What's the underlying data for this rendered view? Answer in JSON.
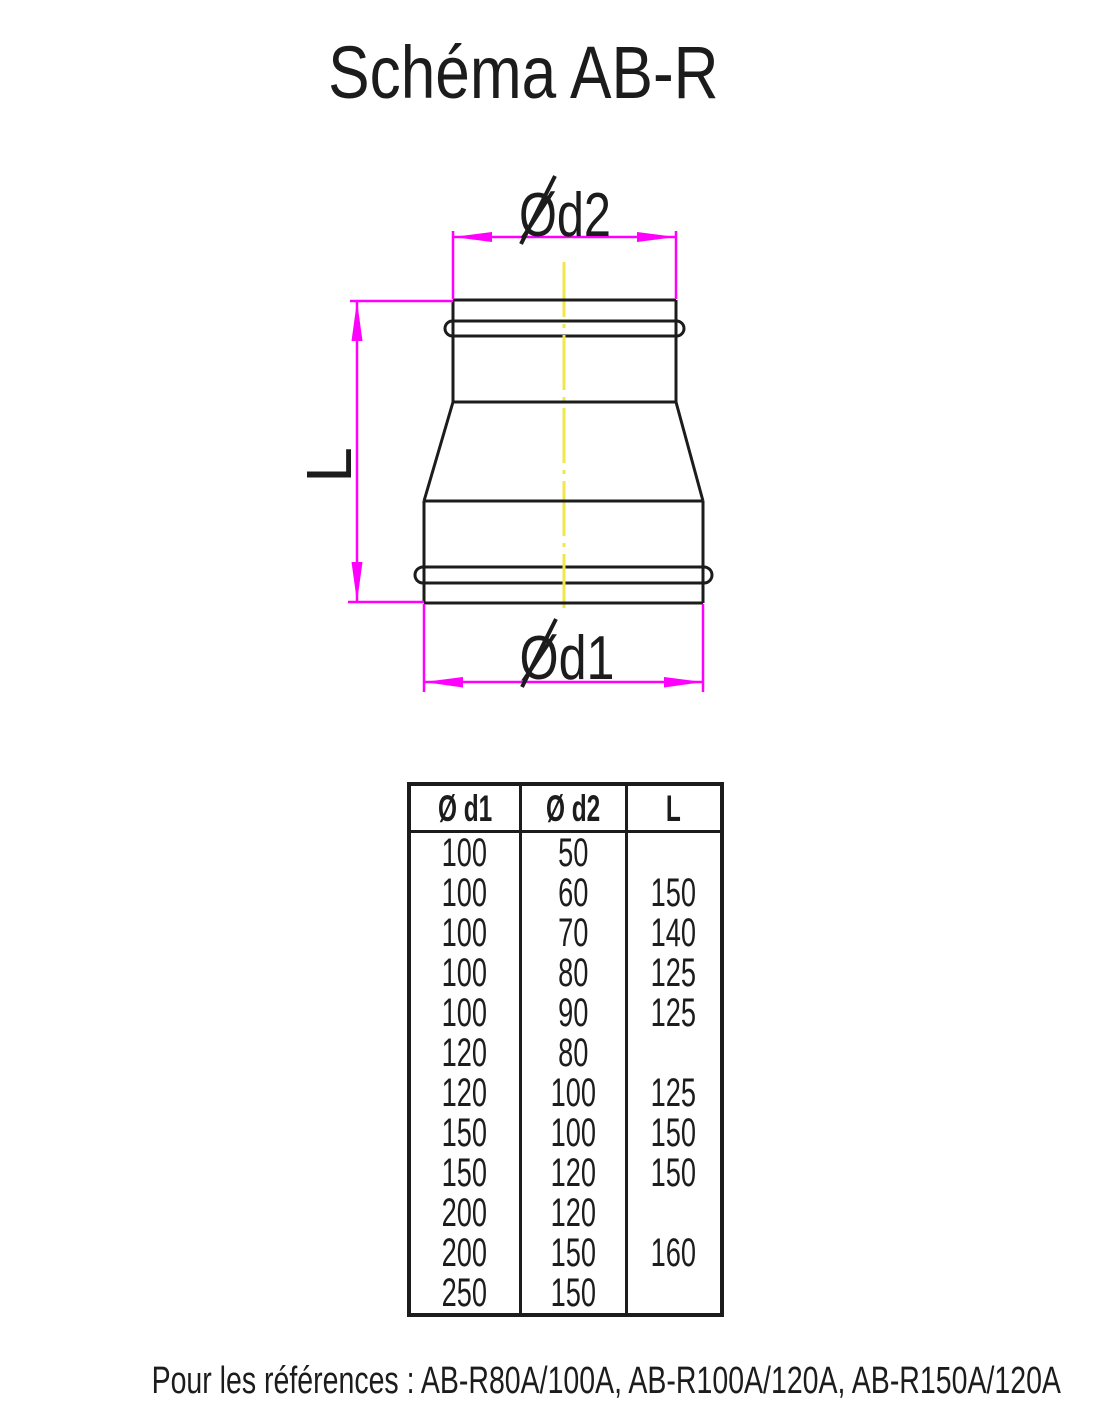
{
  "page": {
    "title": "Schéma AB-R",
    "footer": "Pour les références : AB-R80A/100A, AB-R100A/120A, AB-R150A/120A"
  },
  "diagram": {
    "labels": {
      "d2": "Ød2",
      "d1": "Ød1",
      "length": "L"
    },
    "colors": {
      "dimension": "#FF00FF",
      "centerline": "#F2E74A",
      "outline": "#1C1C1C"
    }
  },
  "table": {
    "headers": [
      "Ø d1",
      "Ø d2",
      "L"
    ],
    "rows": [
      [
        "100",
        "50",
        ""
      ],
      [
        "100",
        "60",
        "150"
      ],
      [
        "100",
        "70",
        "140"
      ],
      [
        "100",
        "80",
        "125"
      ],
      [
        "100",
        "90",
        "125"
      ],
      [
        "120",
        "80",
        ""
      ],
      [
        "120",
        "100",
        "125"
      ],
      [
        "150",
        "100",
        "150"
      ],
      [
        "150",
        "120",
        "150"
      ],
      [
        "200",
        "120",
        ""
      ],
      [
        "200",
        "150",
        "160"
      ],
      [
        "250",
        "150",
        ""
      ]
    ]
  }
}
